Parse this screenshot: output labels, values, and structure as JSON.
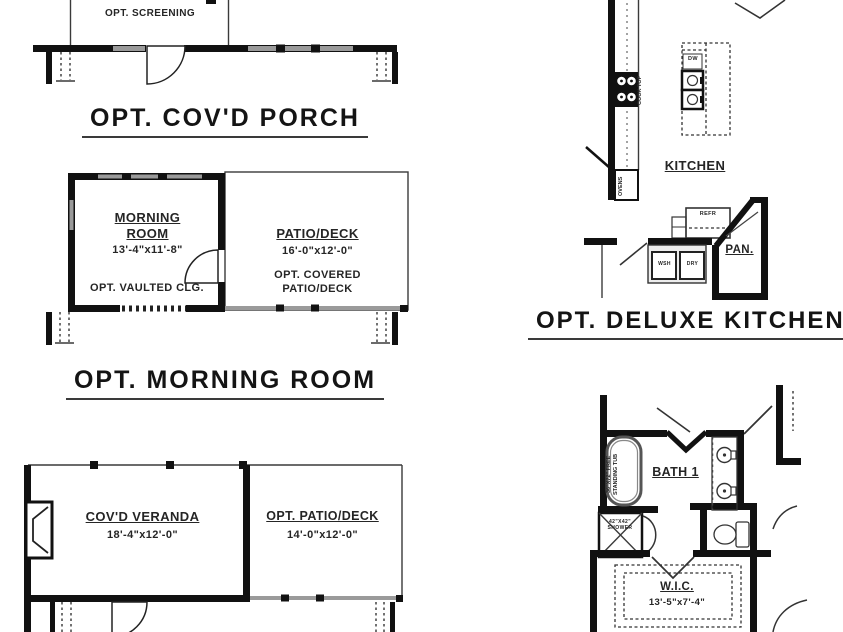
{
  "sheet": {
    "porch": {
      "screening_label": "OPT. SCREENING",
      "title": "OPT. COV'D PORCH"
    },
    "morning_room": {
      "room_name": "MORNING\nROOM",
      "room_dims": "13'-4\"x11'-8\"",
      "room_note": "OPT. VAULTED CLG.",
      "patio_name": "PATIO/DECK",
      "patio_dims": "16'-0\"x12'-0\"",
      "patio_note": "OPT. COVERED\nPATIO/DECK",
      "title": "OPT. MORNING ROOM"
    },
    "veranda": {
      "room_name": "COV'D VERANDA",
      "room_dims": "18'-4\"x12'-0\"",
      "patio_name": "OPT. PATIO/DECK",
      "patio_dims": "14'-0\"x12'-0\""
    },
    "kitchen": {
      "room_name": "KITCHEN",
      "cooktop_label": "COOK TOP",
      "ovens_label": "OVENS",
      "dishwasher_label": "DW",
      "refrigerator_label": "REFR",
      "washer_label": "WSH",
      "dryer_label": "DRY",
      "pantry_label": "PAN.",
      "title": "OPT. DELUXE KITCHEN"
    },
    "bath": {
      "room_name": "BATH 1",
      "tub_label": "36\"X72\" FREE\nSTANDING TUB",
      "shower_label": "42\"X42\"\nSHOWER",
      "wic_name": "W.I.C.",
      "wic_dims": "13'-5\"x7'-4\""
    }
  }
}
